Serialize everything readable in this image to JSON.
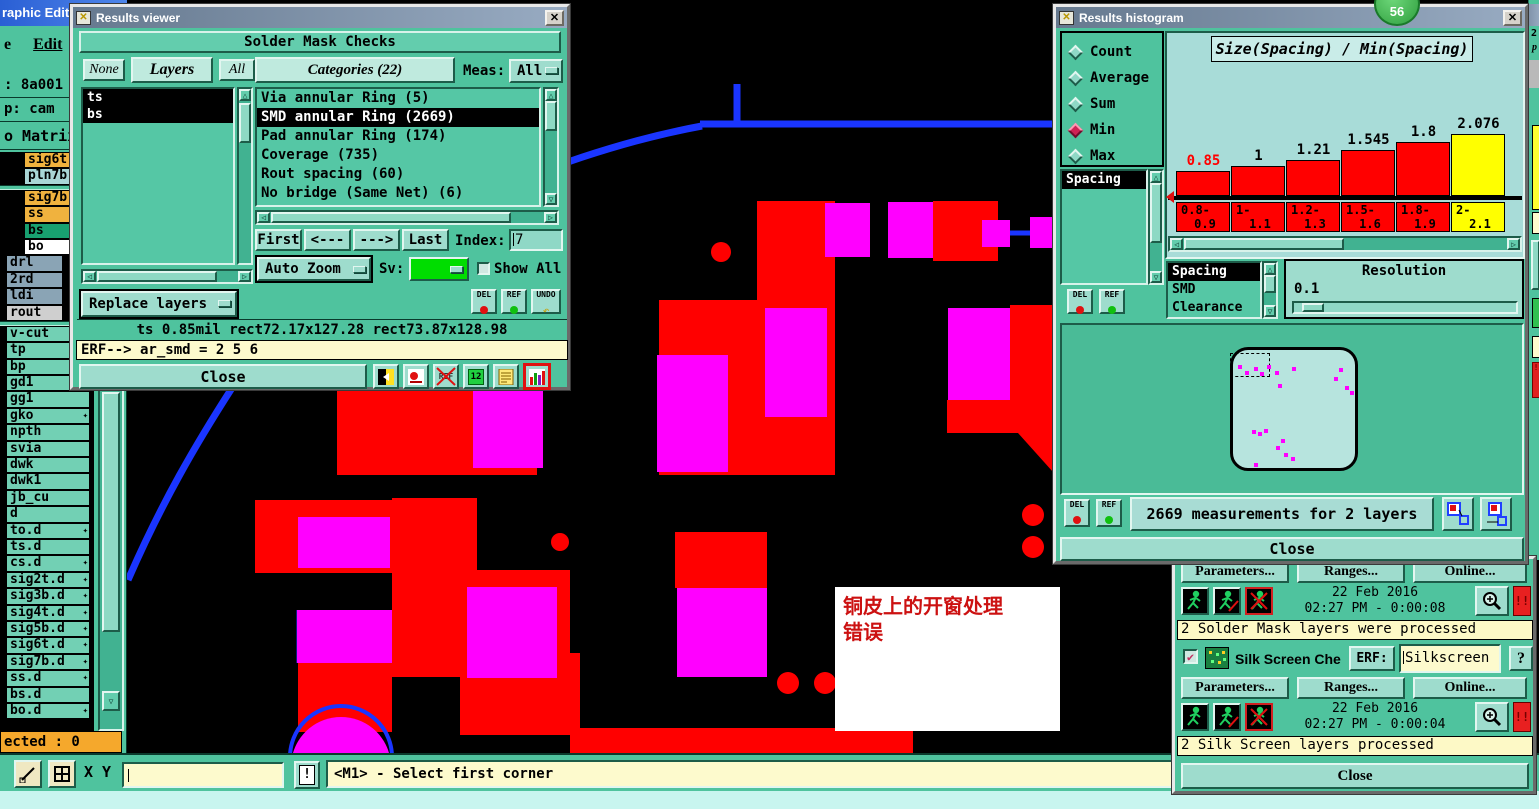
{
  "colors": {
    "pcb_red": "#ff0000",
    "pcb_magenta": "#ff00ff",
    "trace_blue": "#1a35ff",
    "bar_yellow": "#ffff00",
    "window_teal": "#4fc39e",
    "panel_light": "#a8dcd8",
    "status_cream": "#fdf9c8",
    "selected_orange": "#f5a82c"
  },
  "editor": {
    "title_fragment": "raphic Editor",
    "menu_items": [
      "e",
      "Edit"
    ],
    "info_rows": [
      ": 8a001",
      "p: cam",
      "o Matrix"
    ],
    "layers": [
      {
        "label": "sig6t",
        "c": "amber",
        "g": "a"
      },
      {
        "label": "pln7b",
        "c": "paleblue",
        "g": "a"
      },
      {
        "sep": true
      },
      {
        "label": "sig7b",
        "c": "amber",
        "g": "a"
      },
      {
        "label": "ss",
        "c": "amber",
        "g": "a"
      },
      {
        "label": "bs",
        "c": "green",
        "g": "a"
      },
      {
        "label": "bo",
        "c": "white",
        "g": "a"
      },
      {
        "label": "drl",
        "c": "slate",
        "g": "b"
      },
      {
        "label": "2rd",
        "c": "slate",
        "g": "b"
      },
      {
        "label": "ldi",
        "c": "slate",
        "g": "b"
      },
      {
        "label": "rout",
        "c": "lgray",
        "g": "b"
      },
      {
        "sep": true
      },
      {
        "label": "v-cut",
        "c": "teal",
        "g": "c"
      },
      {
        "label": "tp",
        "c": "teal",
        "g": "c"
      },
      {
        "label": "bp",
        "c": "teal",
        "g": "c"
      },
      {
        "label": "gd1",
        "c": "teal",
        "g": "c",
        "arrow": true
      },
      {
        "label": "gg1",
        "c": "teal",
        "g": "c"
      },
      {
        "label": "gko",
        "c": "teal",
        "g": "c",
        "arrow": true
      },
      {
        "label": "npth",
        "c": "teal",
        "g": "c"
      },
      {
        "label": "svia",
        "c": "teal",
        "g": "c"
      },
      {
        "label": "dwk",
        "c": "teal",
        "g": "c"
      },
      {
        "label": "dwk1",
        "c": "teal",
        "g": "c"
      },
      {
        "label": "jb_cu",
        "c": "teal",
        "g": "c"
      },
      {
        "label": "d",
        "c": "teal",
        "g": "c"
      },
      {
        "label": "to.d",
        "c": "teal",
        "g": "c",
        "arrow": true
      },
      {
        "label": "ts.d",
        "c": "teal",
        "g": "c"
      },
      {
        "label": "cs.d",
        "c": "teal",
        "g": "c",
        "arrow": true
      },
      {
        "label": "sig2t.d",
        "c": "teal",
        "g": "c",
        "arrow": true
      },
      {
        "label": "sig3b.d",
        "c": "teal",
        "g": "c",
        "arrow": true
      },
      {
        "label": "sig4t.d",
        "c": "teal",
        "g": "c",
        "arrow": true
      },
      {
        "label": "sig5b.d",
        "c": "teal",
        "g": "c",
        "arrow": true
      },
      {
        "label": "sig6t.d",
        "c": "teal",
        "g": "c",
        "arrow": true
      },
      {
        "label": "sig7b.d",
        "c": "teal",
        "g": "c",
        "arrow": true
      },
      {
        "label": "ss.d",
        "c": "teal",
        "g": "c",
        "arrow": true
      },
      {
        "label": "bs.d",
        "c": "teal",
        "g": "c"
      },
      {
        "label": "bo.d",
        "c": "teal",
        "g": "c",
        "arrow": true
      }
    ],
    "selected_count_bar": "ected : 0",
    "xy_label": "X Y :",
    "warn_button": "!",
    "status_hint": "<M1> - Select first corner"
  },
  "results_viewer": {
    "title": "Results viewer",
    "header": "Solder Mask Checks",
    "none_btn": "None",
    "layers_btn": "Layers",
    "all_btn": "All",
    "layer_items": [
      "ts",
      "bs"
    ],
    "categories_header": "Categories (22)",
    "meas_label": "Meas:",
    "meas_value": "All",
    "categories": [
      "Via annular Ring (5)",
      "SMD annular Ring (2669)",
      "Pad annular Ring (174)",
      "Coverage (735)",
      "Rout spacing (60)",
      "No bridge (Same Net) (6)"
    ],
    "selected_category_index": 1,
    "nav": {
      "first": "First",
      "prev": "<---",
      "next": "--->",
      "last": "Last",
      "index_label": "Index:",
      "index_value": "7"
    },
    "auto_zoom": "Auto Zoom",
    "sv_label": "Sv:",
    "show_all": "Show All",
    "replace_layers": "Replace layers",
    "del": "DEL",
    "ref": "REF",
    "undo": "UNDO",
    "icon_12": "12",
    "status": "ts 0.85mil  rect72.17x127.28  rect73.87x128.98",
    "erf_line": "ERF--> ar_smd = 2 5 6",
    "close": "Close"
  },
  "results_histogram": {
    "title": "Results histogram",
    "radios": [
      "Count",
      "Average",
      "Sum",
      "Min",
      "Max"
    ],
    "selected_radio": "Min",
    "measure_list": [
      "Spacing"
    ],
    "type_list": [
      "Spacing",
      "SMD",
      "Clearance"
    ],
    "selected_type_index": 0,
    "resolution_label": "Resolution",
    "resolution_value": "0.1",
    "del": "DEL",
    "ref": "REF",
    "measurements_text": "2669 measurements for 2 layers",
    "close": "Close"
  },
  "chart_data": {
    "type": "bar",
    "title": "Size(Spacing) / Min(Spacing)",
    "categories": [
      "0.8-0.9",
      "1-1.1",
      "1.2-1.3",
      "1.5-1.6",
      "1.8-1.9",
      "2-2.1"
    ],
    "values": [
      0.85,
      1,
      1.21,
      1.545,
      1.8,
      2.076
    ],
    "value_labels": [
      "0.85",
      "1",
      "1.21",
      "1.545",
      "1.8",
      "2.076"
    ],
    "bar_colors": [
      "#ff0000",
      "#ff0000",
      "#ff0000",
      "#ff0000",
      "#ff0000",
      "#ffff00"
    ],
    "value_label_colors": [
      "#ff0000",
      "#000000",
      "#000000",
      "#000000",
      "#000000",
      "#000000"
    ],
    "xlabel": "",
    "ylabel": "",
    "legend": false,
    "grid": false
  },
  "checks_panel": {
    "sections": [
      {
        "buttons": [
          "Parameters...",
          "Ranges...",
          "Online..."
        ],
        "date": "22 Feb 2016",
        "time": "02:27 PM - 0:00:08",
        "status": "2 Solder Mask layers were processed"
      },
      {
        "check_label": "Silk Screen Che",
        "erf_label": "ERF:",
        "erf_value": "Silkscreen",
        "help": "?",
        "buttons": [
          "Parameters...",
          "Ranges...",
          "Online..."
        ],
        "date": "22 Feb 2016",
        "time": "02:27 PM - 0:00:04",
        "status": "2 Silk Screen layers processed"
      }
    ],
    "alert": "!!",
    "close": "Close"
  },
  "annotation": {
    "line1": "铜皮上的开窗处理",
    "line2": "错误"
  },
  "overlay_badge": "56",
  "edge_fragments": {
    "t1": "2",
    "t2": "p",
    "warn": "!"
  }
}
